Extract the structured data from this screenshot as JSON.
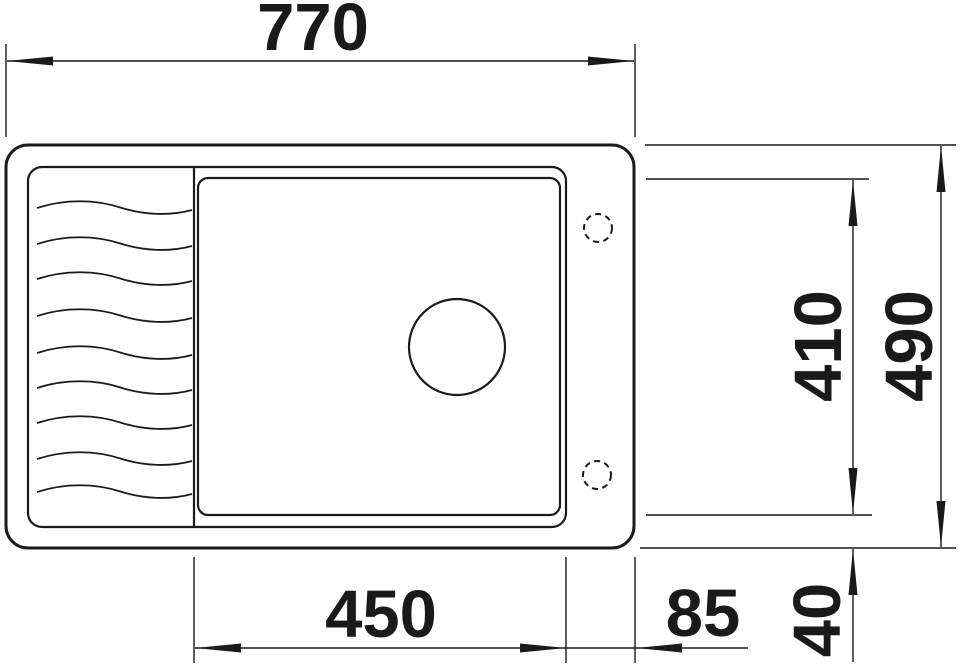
{
  "drawing": {
    "view": "sink-top-view-dimension-drawing",
    "dimensions": {
      "overall_width": "770",
      "overall_depth": "490",
      "bowl_depth": "410",
      "bowl_width": "450",
      "right_ledge": "85",
      "bottom_ledge": "40"
    },
    "colors": {
      "line": "#1a1a1a",
      "background": "#ffffff"
    }
  }
}
